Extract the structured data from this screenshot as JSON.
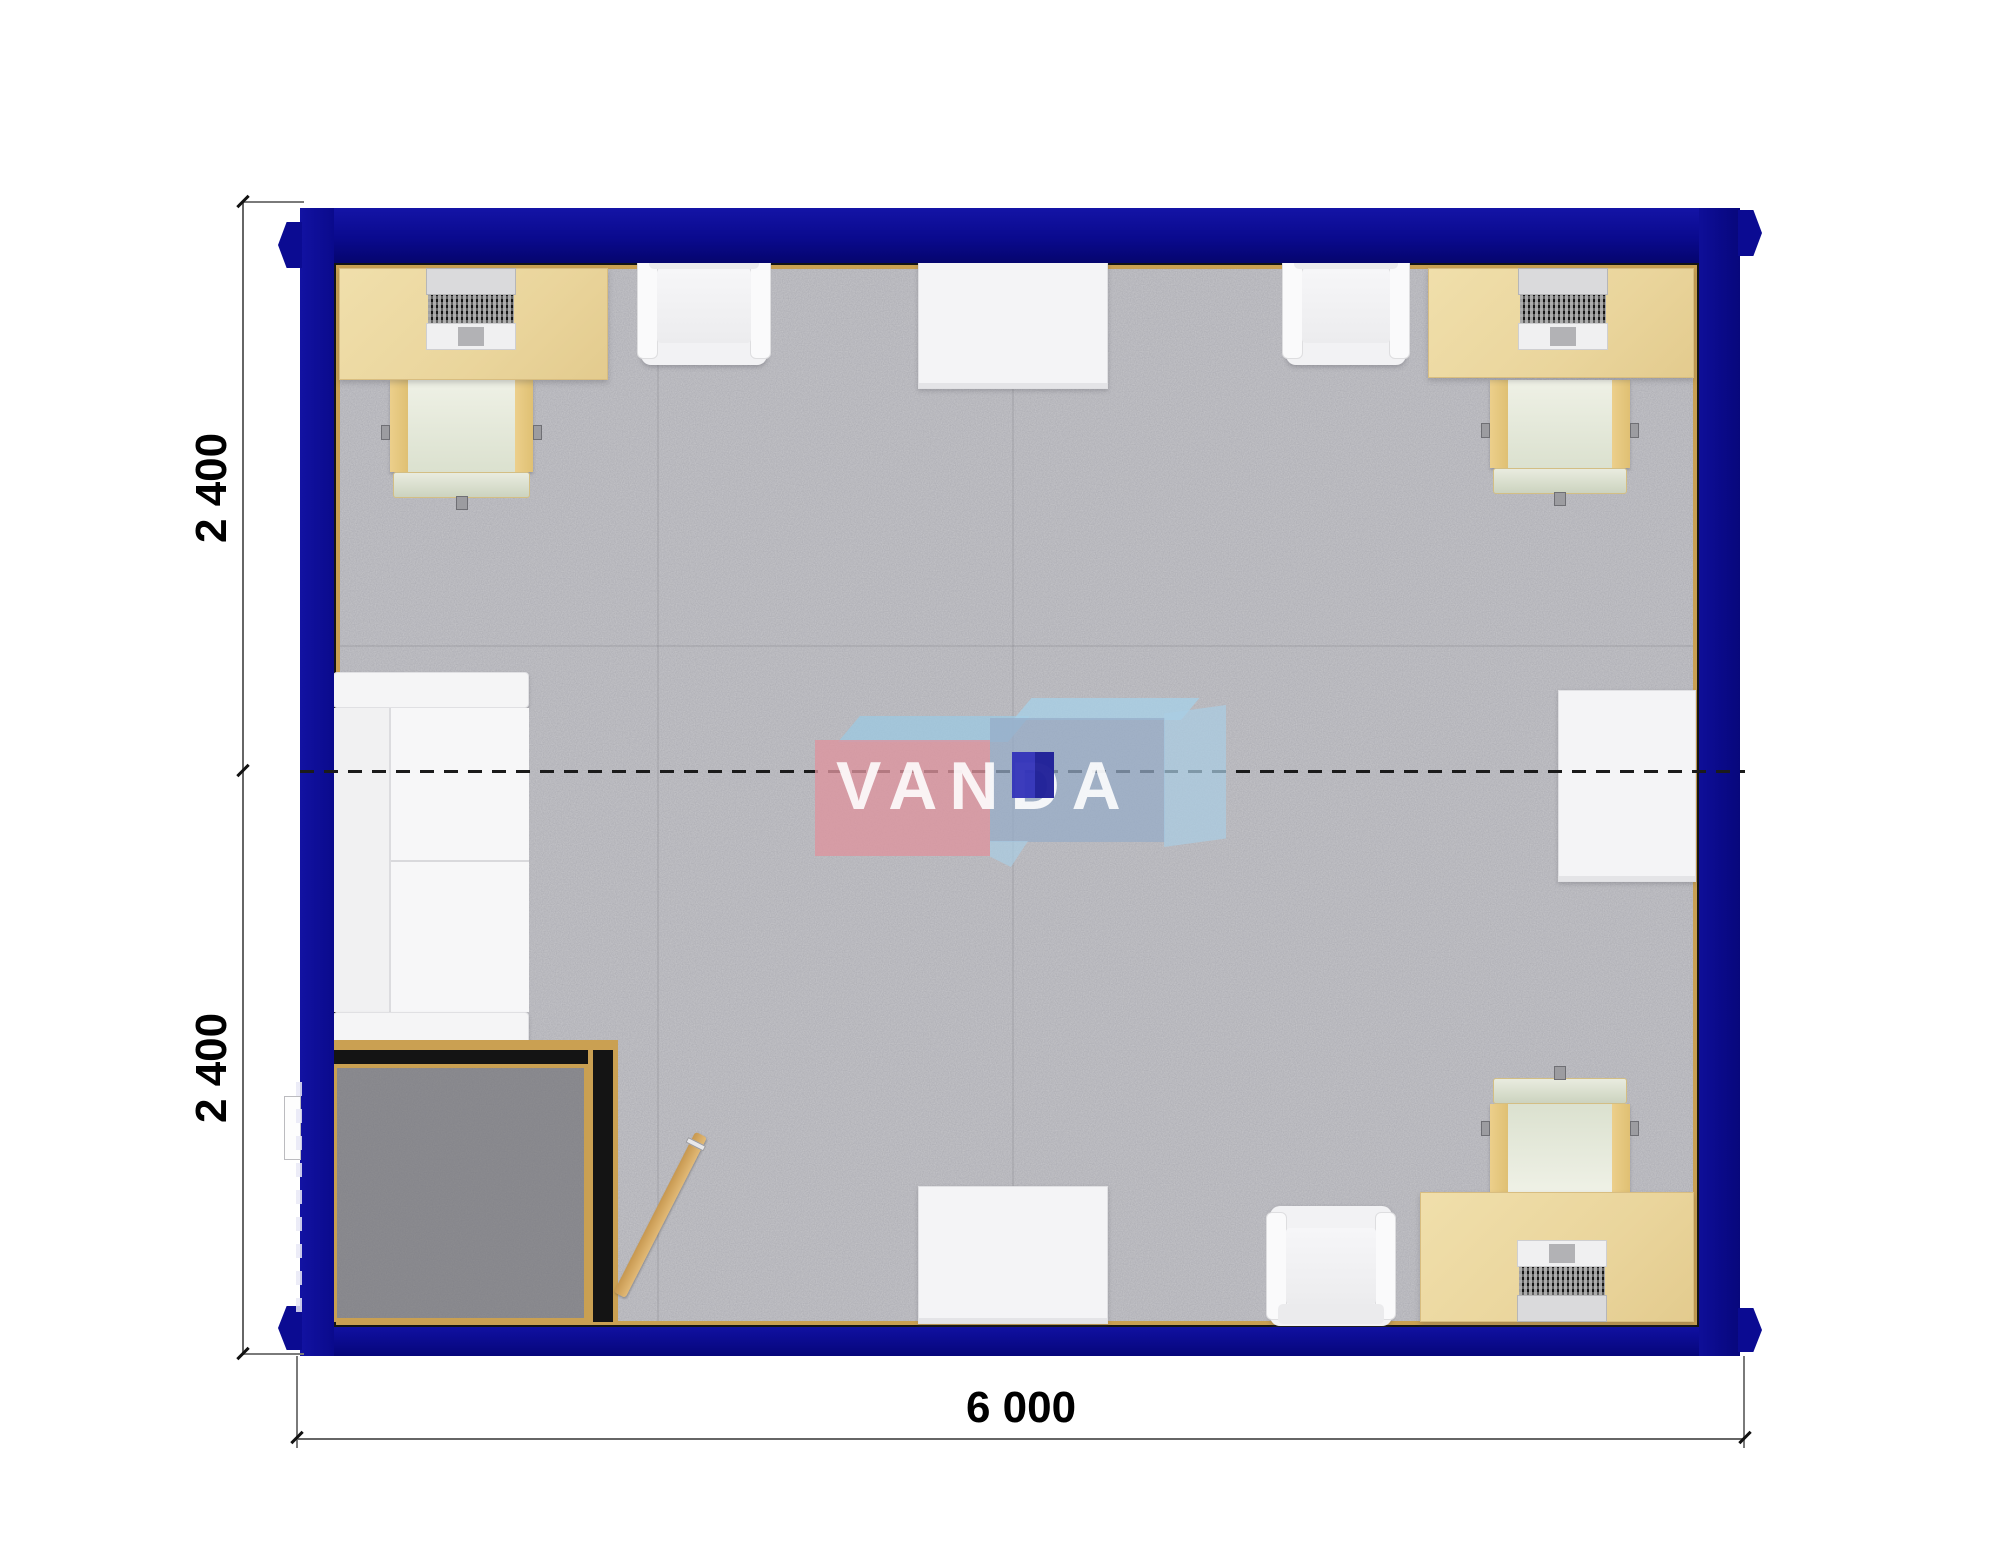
{
  "plan": {
    "title_note": "modular container office floor plan",
    "watermark": {
      "text": "VANDA"
    },
    "dimensions": {
      "left_top": "2 400",
      "left_bottom": "2 400",
      "bottom": "6 000"
    },
    "colors": {
      "wall_blue": "#0a0a90",
      "trim_gold": "#c9a052",
      "desk_beige": "#ecd8a2",
      "floor_gray": "#c7c7cb",
      "vestibule_floor": "#8e8e91",
      "watermark_pink": "#de939e",
      "watermark_blue": "#96acc8",
      "watermark_square": "#2a2ab0"
    },
    "furniture_symbols": [
      "desk",
      "laptop",
      "office-chair",
      "armchair",
      "table",
      "sofa",
      "entry-vestibule",
      "door-leaf"
    ]
  }
}
